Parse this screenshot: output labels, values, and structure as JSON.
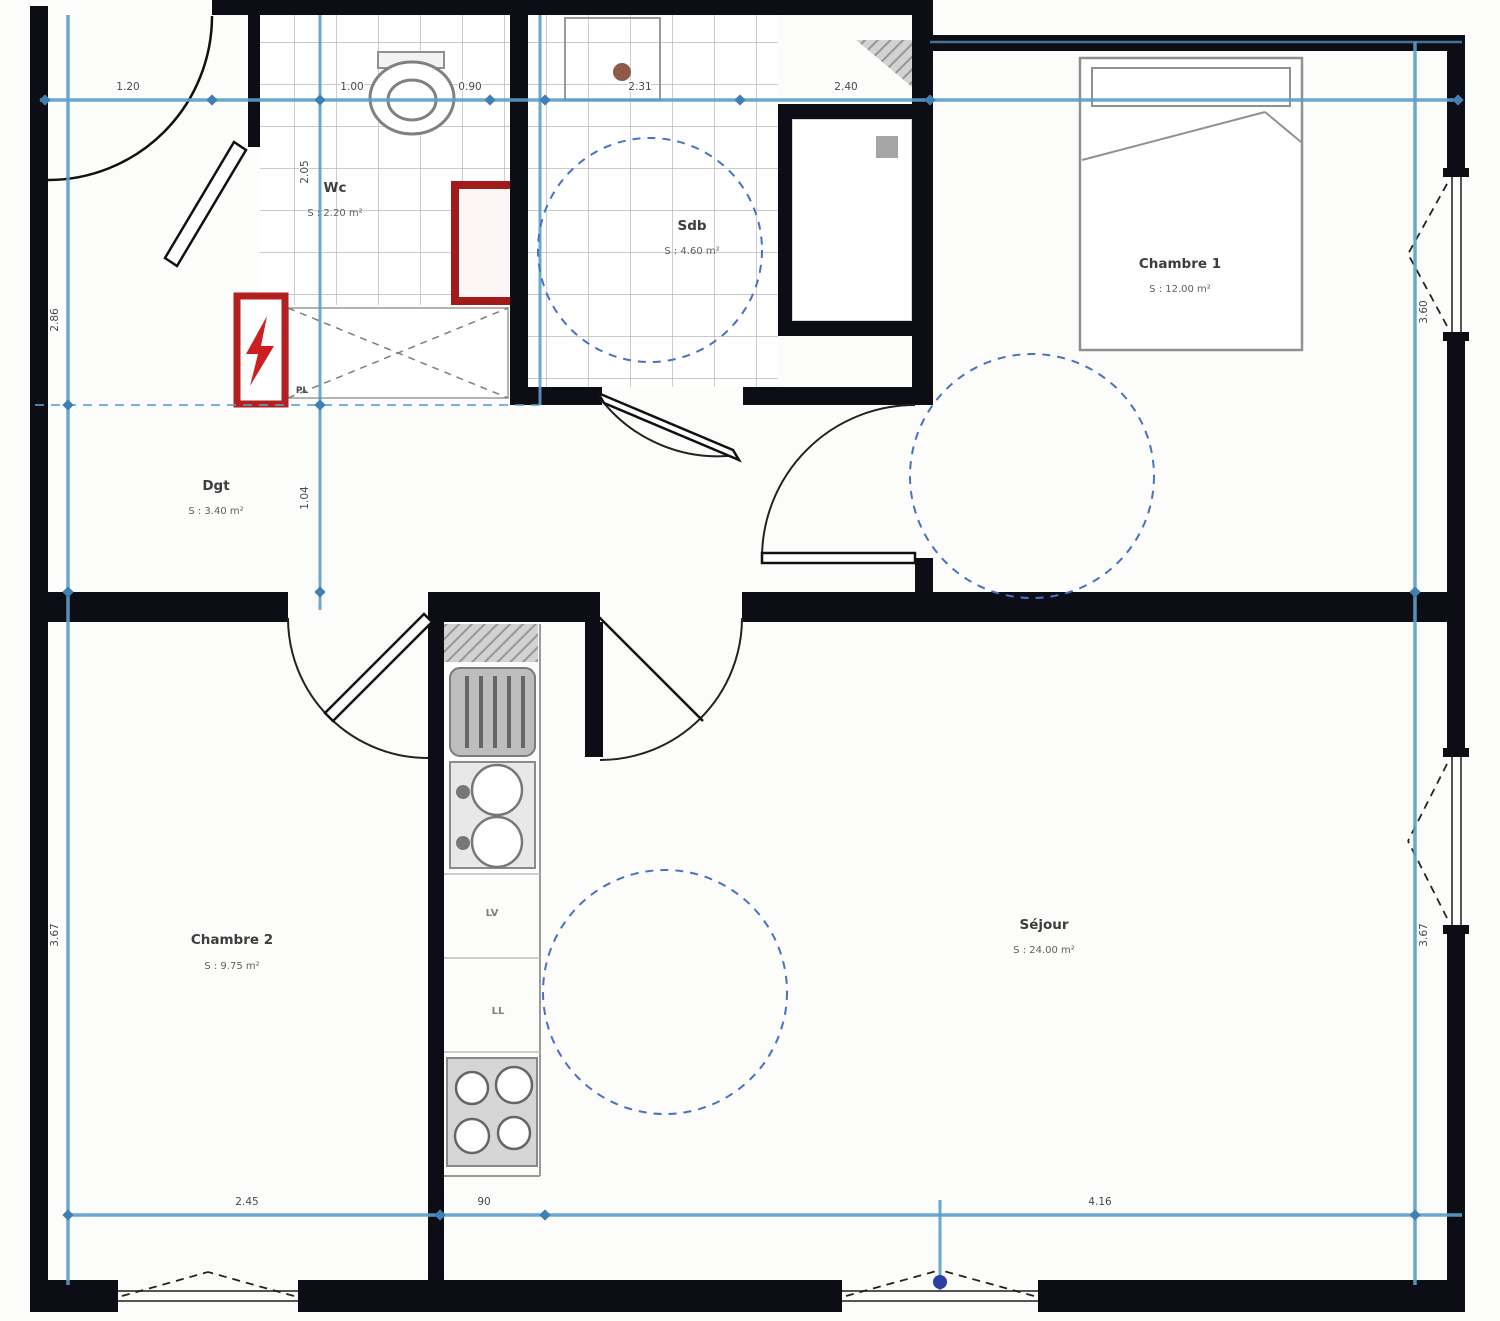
{
  "rooms": {
    "wc": {
      "name": "Wc",
      "area": "S : 2.20 m²"
    },
    "sdb": {
      "name": "Sdb",
      "area": "S : 4.60 m²"
    },
    "chambre1": {
      "name": "Chambre 1",
      "area": "S : 12.00 m²"
    },
    "dgt": {
      "name": "Dgt",
      "area": "S : 3.40 m²"
    },
    "chambre2": {
      "name": "Chambre 2",
      "area": "S : 9.75 m²"
    },
    "sejour": {
      "name": "Séjour",
      "area": "S : 24.00 m²"
    }
  },
  "fixtures": {
    "closet": "PL",
    "dishwasher": "LV",
    "washing_machine": "LL"
  },
  "dimensions": {
    "top": {
      "d1": "1.20",
      "d2": "1.00",
      "d3": "0.90",
      "d4": "2.31",
      "d5": "2.40"
    },
    "left": {
      "d1": "2.86",
      "d2": "3.67"
    },
    "right": {
      "d1": "3.60",
      "d2": "3.67"
    },
    "interior": {
      "d1": "2.05",
      "d2": "1.04"
    },
    "bottom": {
      "d1": "2.45",
      "d2": "90",
      "d3": "4.16"
    }
  },
  "colors": {
    "wall": "#0d0d16",
    "dimension_blue": "#5b9fc9",
    "clearance_blue": "#4472c4",
    "safety_red": "#b32020",
    "fixture_gray": "#8f8f8f"
  }
}
